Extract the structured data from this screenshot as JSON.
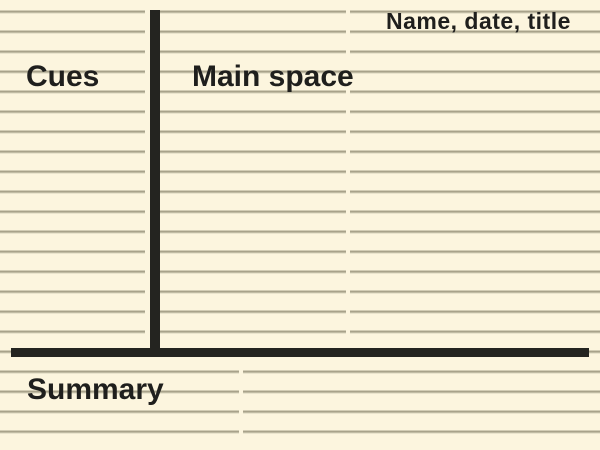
{
  "template": {
    "name": "cornell-notes-layout"
  },
  "labels": {
    "header": "Name, date, title",
    "cues": "Cues",
    "main_space": "Main space",
    "summary": "Summary"
  },
  "colors": {
    "paper": "#fcf5de",
    "rule_dark": "#a8a28a",
    "rule_light": "#d9d4bc",
    "divider": "#242420",
    "text": "#1f1f1d"
  }
}
